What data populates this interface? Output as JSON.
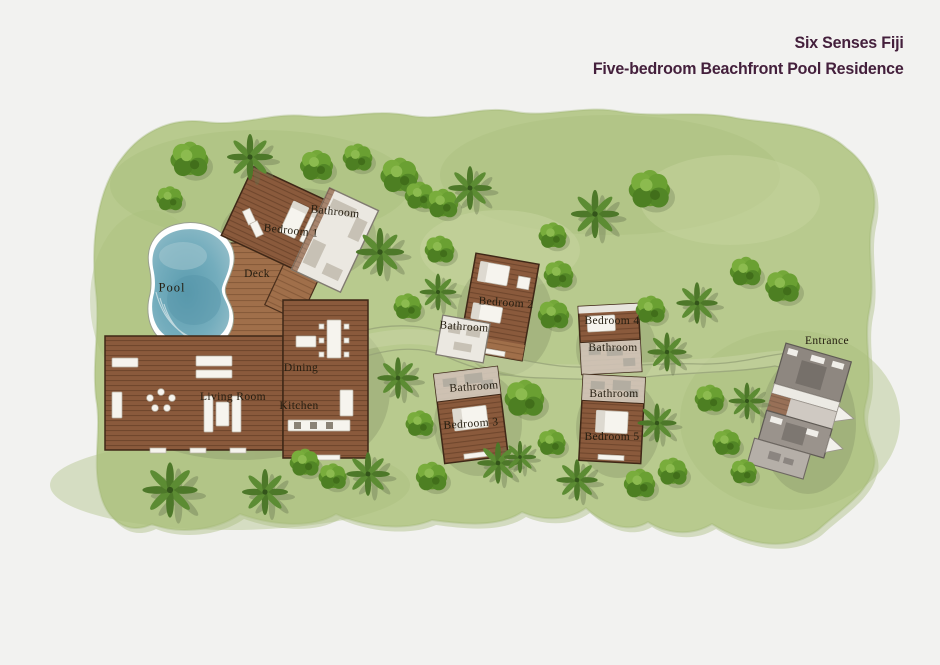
{
  "title": {
    "line1": "Six Senses Fiji",
    "line2": "Five-bedroom Beachfront Pool Residence"
  },
  "labels": {
    "pool": "Pool",
    "deck": "Deck",
    "bedroom1": "Bedroom 1",
    "bathroom1": "Bathroom",
    "living_room": "Living Room",
    "dining": "Dining",
    "kitchen": "Kitchen",
    "bedroom2": "Bedroom 2",
    "bathroom2": "Bathroom",
    "bedroom3": "Bedroom 3",
    "bathroom3": "Bathroom",
    "bedroom4": "Bedroom 4",
    "bathroom4": "Bathroom",
    "bedroom5": "Bedroom 5",
    "bathroom5": "Bathroom",
    "entrance": "Entrance"
  },
  "colors": {
    "title_text": "#44203c",
    "lawn": "#b8ca8e",
    "pool_water": "#74adbd",
    "wood": "#8a5a3c",
    "roof_grey": "#9a938c",
    "background": "#f2f2f0"
  }
}
